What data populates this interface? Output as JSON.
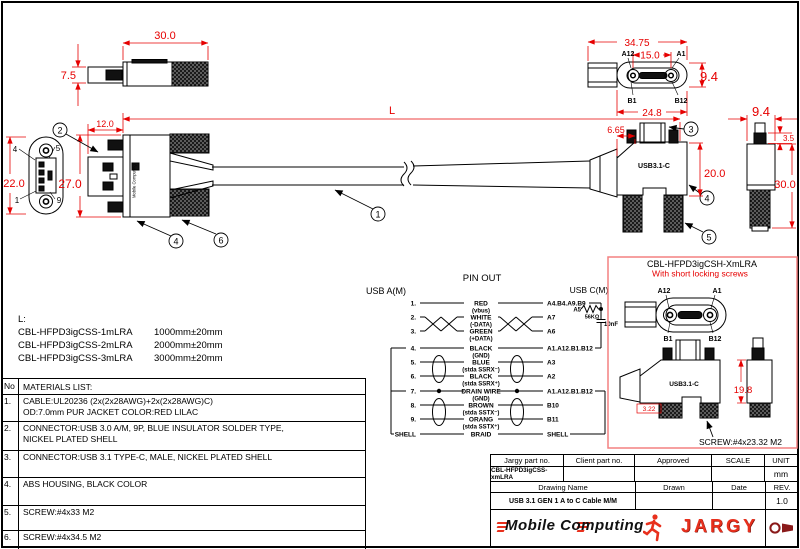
{
  "dims": {
    "top_plug_len": "30.0",
    "top_plug_h": "7.5",
    "a_shell_len": "12.0",
    "a_body_h": "27.0",
    "a_face_h": "22.0",
    "cable_len": "L",
    "cface_w": "34.75",
    "cface_pitch": "15.0",
    "cface_h": "9.4",
    "cface_slot": "24.8",
    "c_top_offset": "6.65",
    "c_body_h": "20.0",
    "cside_w": "9.4",
    "cside_tab": "3.5",
    "cside_h": "30.0"
  },
  "a_face_pins": {
    "tl": "4",
    "tr": "5",
    "bl": "1",
    "br": "9"
  },
  "c_face_pins": {
    "tl": "A12",
    "tr": "A1",
    "bl": "B1",
    "br": "B12"
  },
  "callouts": [
    "1",
    "2",
    "3",
    "4",
    "5",
    "6"
  ],
  "connector_label": "USB3.1-C",
  "overmold_label": "Mobile Computing",
  "length_table": {
    "title": "L:",
    "rows": [
      {
        "part": "CBL-HFPD3igCSS-1mLRA",
        "len": "1000mm±20mm"
      },
      {
        "part": "CBL-HFPD3igCSS-2mLRA",
        "len": "2000mm±20mm"
      },
      {
        "part": "CBL-HFPD3igCSS-3mLRA",
        "len": "3000mm±20mm"
      }
    ]
  },
  "pinout": {
    "title": "PIN OUT",
    "left_header": "USB A(M)",
    "right_header": "USB C(M)",
    "a5": "A5",
    "resistor": "56KΩ",
    "capacitor": "10nF",
    "rows": [
      {
        "n": "1.",
        "color": "RED",
        "signal": "(vbus)",
        "cpin": "A4.B4.A9.B9"
      },
      {
        "n": "2.",
        "color": "WHITE",
        "signal": "(-DATA)",
        "cpin": "A7"
      },
      {
        "n": "3.",
        "color": "GREEN",
        "signal": "(+DATA)",
        "cpin": "A6"
      },
      {
        "n": "4.",
        "color": "BLACK",
        "signal": "(GND)",
        "cpin": "A1.A12.B1.B12"
      },
      {
        "n": "5.",
        "color": "BLUE",
        "signal": "(stda SSRX⁻)",
        "cpin": "A3"
      },
      {
        "n": "6.",
        "color": "BLACK",
        "signal": "(stda SSRX⁺)",
        "cpin": "A2"
      },
      {
        "n": "7.",
        "color": "DRAIN WIRE",
        "signal": "(GND)",
        "cpin": "A1.A12.B1.B12"
      },
      {
        "n": "8.",
        "color": "BROWN",
        "signal": "(stda SSTX⁻)",
        "cpin": "B10"
      },
      {
        "n": "9.",
        "color": "ORANG",
        "signal": "(stda SSTX⁺)",
        "cpin": "B11"
      },
      {
        "n": "SHELL",
        "color": "BRAID",
        "signal": "",
        "cpin": "SHELL"
      }
    ]
  },
  "variant": {
    "title": "CBL-HFPD3igCSH-XmLRA",
    "subtitle": "With short locking screws",
    "dim_h": "19.8",
    "dim_small": "3.22",
    "screw_note": "SCREW:#4x23.32 M2"
  },
  "materials": {
    "no_header": "No",
    "title": "MATERIALS LIST:",
    "rows": [
      {
        "no": "1.",
        "line1": "CABLE:UL20236 (2x(2x28AWG)+2x(2x28AWG)C)",
        "line2": "OD:7.0mm  PUR JACKET COLOR:RED LILAC"
      },
      {
        "no": "2.",
        "line1": "CONNECTOR:USB 3.0 A/M, 9P, BLUE INSULATOR SOLDER TYPE,",
        "line2": "NICKEL PLATED SHELL"
      },
      {
        "no": "3.",
        "line1": "CONNECTOR:USB 3.1 TYPE-C, MALE, NICKEL PLATED SHELL",
        "line2": ""
      },
      {
        "no": "4.",
        "line1": "ABS HOUSING, BLACK COLOR",
        "line2": ""
      },
      {
        "no": "5.",
        "line1": "SCREW:#4x33 M2",
        "line2": ""
      },
      {
        "no": "6.",
        "line1": "SCREW:#4x34.5 M2",
        "line2": ""
      }
    ]
  },
  "title_block": {
    "h_jargy": "Jargy part no.",
    "h_client": "Client part no.",
    "h_approved": "Approved",
    "h_scale": "SCALE",
    "h_unit": "UNIT",
    "part_no": "CBL-HFPD3igCSS-xmLRA",
    "unit": "mm",
    "h_drawing": "Drawing Name",
    "h_drawn": "Drawn",
    "h_date": "Date",
    "h_rev": "REV.",
    "drawing_name": "USB 3.1 GEN 1 A to C Cable M/M",
    "rev": "1.0",
    "brand_left": "Mobile Computing",
    "brand_right": "JARGY"
  }
}
